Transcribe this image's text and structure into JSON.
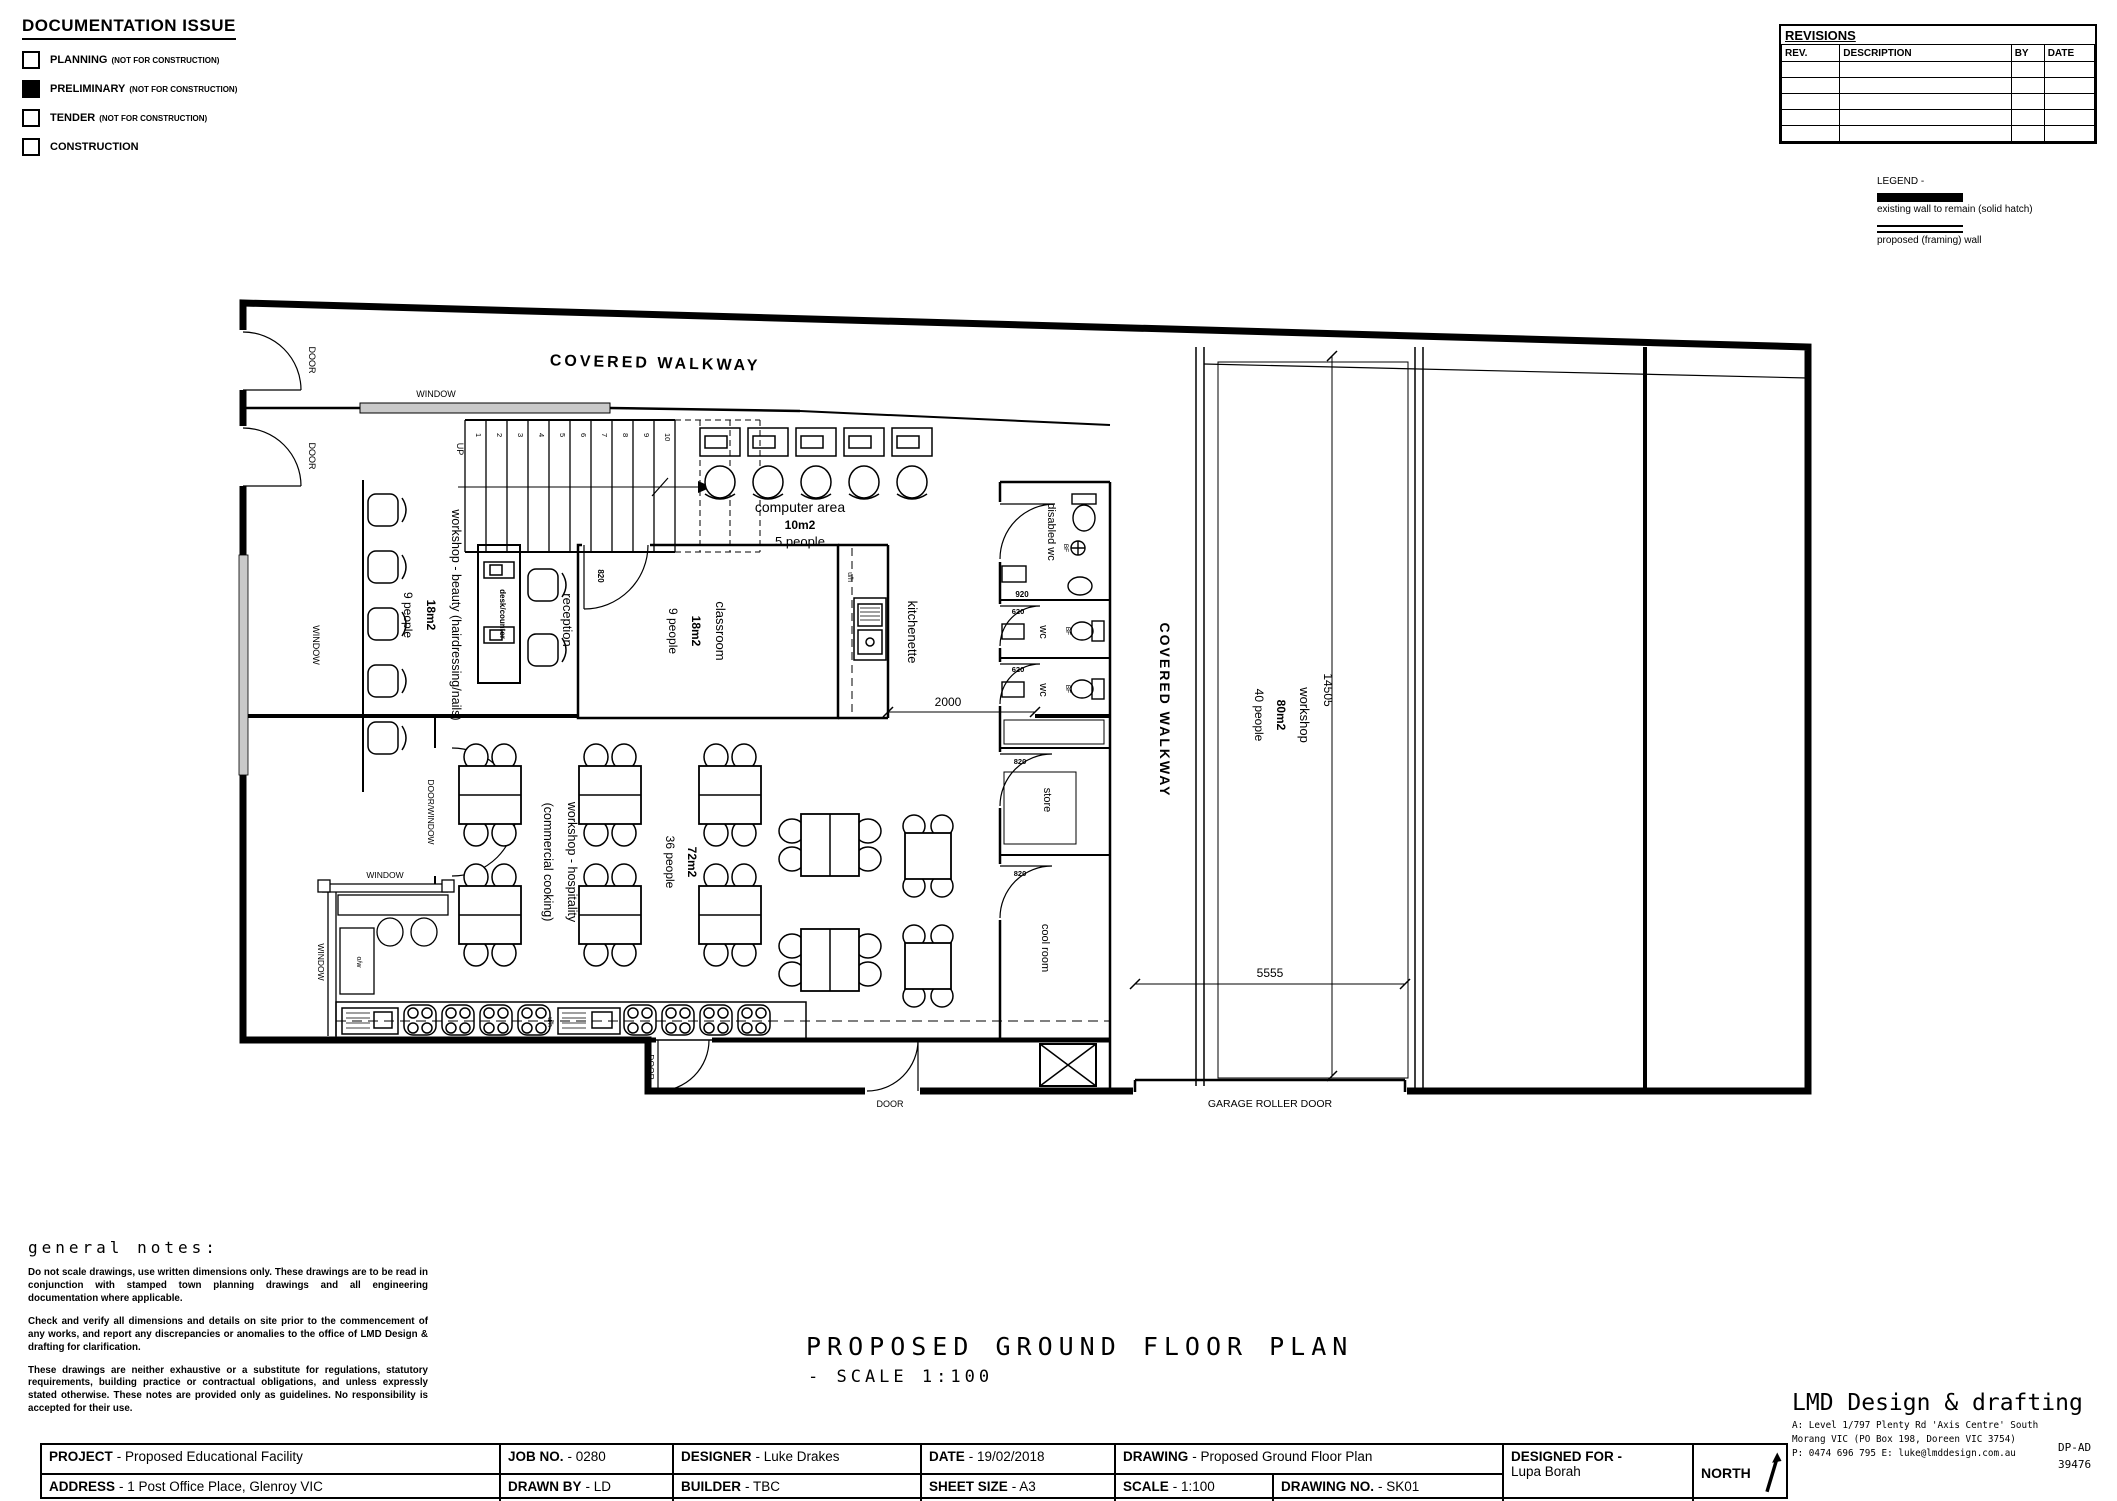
{
  "doc_issue": {
    "title": "DOCUMENTATION ISSUE",
    "items": [
      {
        "label": "PLANNING",
        "suffix": "(NOT FOR CONSTRUCTION)",
        "checked": false
      },
      {
        "label": "PRELIMINARY",
        "suffix": "(NOT FOR CONSTRUCTION)",
        "checked": true
      },
      {
        "label": "TENDER",
        "suffix": "(NOT FOR CONSTRUCTION)",
        "checked": false
      },
      {
        "label": "CONSTRUCTION",
        "suffix": "",
        "checked": false
      }
    ]
  },
  "revisions": {
    "title": "REVISIONS",
    "headers": {
      "rev": "REV.",
      "description": "DESCRIPTION",
      "by": "BY",
      "date": "DATE"
    }
  },
  "legend": {
    "title": "LEGEND -",
    "existing": "existing wall to remain (solid hatch)",
    "proposed": "proposed (framing) wall"
  },
  "plan": {
    "labels": {
      "covered_walkway": "COVERED WALKWAY",
      "door": "DOOR",
      "window": "WINDOW",
      "door_window": "DOOR/WINDOW",
      "up": "UP",
      "garage": "GARAGE ROLLER DOOR",
      "uh": "u/h",
      "ow": "o/w",
      "bf": "BF",
      "d820": "820",
      "d920": "920",
      "d620": "620"
    },
    "stairs": {
      "numbers": [
        "1",
        "2",
        "3",
        "4",
        "5",
        "6",
        "7",
        "8",
        "9",
        "10"
      ]
    },
    "rooms": {
      "computer": {
        "name": "computer area",
        "area": "10m2",
        "capacity": "5 people"
      },
      "beauty": {
        "name": "workshop - beauty (hairdressing/nails)",
        "area": "18m2",
        "capacity": "9 people"
      },
      "reception": {
        "name": "reception",
        "desk": "desk/counter"
      },
      "classroom": {
        "name": "classroom",
        "area": "18m2",
        "capacity": "9 people"
      },
      "kitchenette": {
        "name": "kitchenette"
      },
      "disabled_wc": {
        "name": "disabled wc"
      },
      "wc": {
        "name": "wc"
      },
      "store": {
        "name": "store"
      },
      "cool_room": {
        "name": "cool room"
      },
      "workshop": {
        "name": "workshop",
        "area": "80m2",
        "capacity": "40 people"
      },
      "hospitality": {
        "name": "workshop - hospitality",
        "name2": "(commercial cooking)",
        "area": "72m2",
        "capacity": "36 people"
      }
    },
    "dimensions": {
      "opening": "2000",
      "garage_width": "5555",
      "depth": "14505"
    }
  },
  "notes": {
    "heading": "general notes:",
    "p1": "Do not scale drawings, use written dimensions only. These drawings are to be read in conjunction with stamped town planning drawings and all engineering documentation where applicable.",
    "p2": "Check and verify all dimensions and details on site prior to the commencement of any works, and report any discrepancies or anomalies to the office of LMD Design & drafting for clarification.",
    "p3": "These drawings are neither exhaustive or a substitute for regulations, statutory requirements, building practice or contractual obligations, and unless expressly stated otherwise. These notes are provided only as guidelines. No responsibility is accepted for their use."
  },
  "main_title": {
    "line1": "PROPOSED GROUND FLOOR PLAN",
    "line2": "- SCALE 1:100"
  },
  "titleblock": {
    "project": {
      "label": "PROJECT",
      "value": "- Proposed Educational Facility"
    },
    "address": {
      "label": "ADDRESS",
      "value": "- 1 Post Office Place, Glenroy VIC"
    },
    "job": {
      "label": "JOB NO.",
      "value": "- 0280"
    },
    "drawn_by": {
      "label": "DRAWN BY",
      "value": "- LD"
    },
    "designer": {
      "label": "DESIGNER",
      "value": "- Luke Drakes"
    },
    "builder": {
      "label": "BUILDER",
      "value": "- TBC"
    },
    "date": {
      "label": "DATE",
      "value": "- 19/02/2018"
    },
    "sheet_size": {
      "label": "SHEET SIZE",
      "value": "- A3"
    },
    "drawing": {
      "label": "DRAWING",
      "value": "- Proposed Ground Floor Plan"
    },
    "scale": {
      "label": "SCALE",
      "value": "- 1:100"
    },
    "drawing_no": {
      "label": "DRAWING NO.",
      "value": "- SK01"
    },
    "designed_for": {
      "label": "DESIGNED FOR -",
      "value": "Lupa Borah"
    },
    "north": "NORTH"
  },
  "brand": {
    "name": "LMD Design & drafting",
    "addr1": "A: Level 1/797 Plenty Rd 'Axis Centre' South",
    "addr2": "Morang VIC (PO Box 198, Doreen VIC 3754)",
    "addr3": "P: 0474 696 795   E: luke@lmddesign.com.au",
    "code1": "DP-AD",
    "code2": "39476"
  }
}
